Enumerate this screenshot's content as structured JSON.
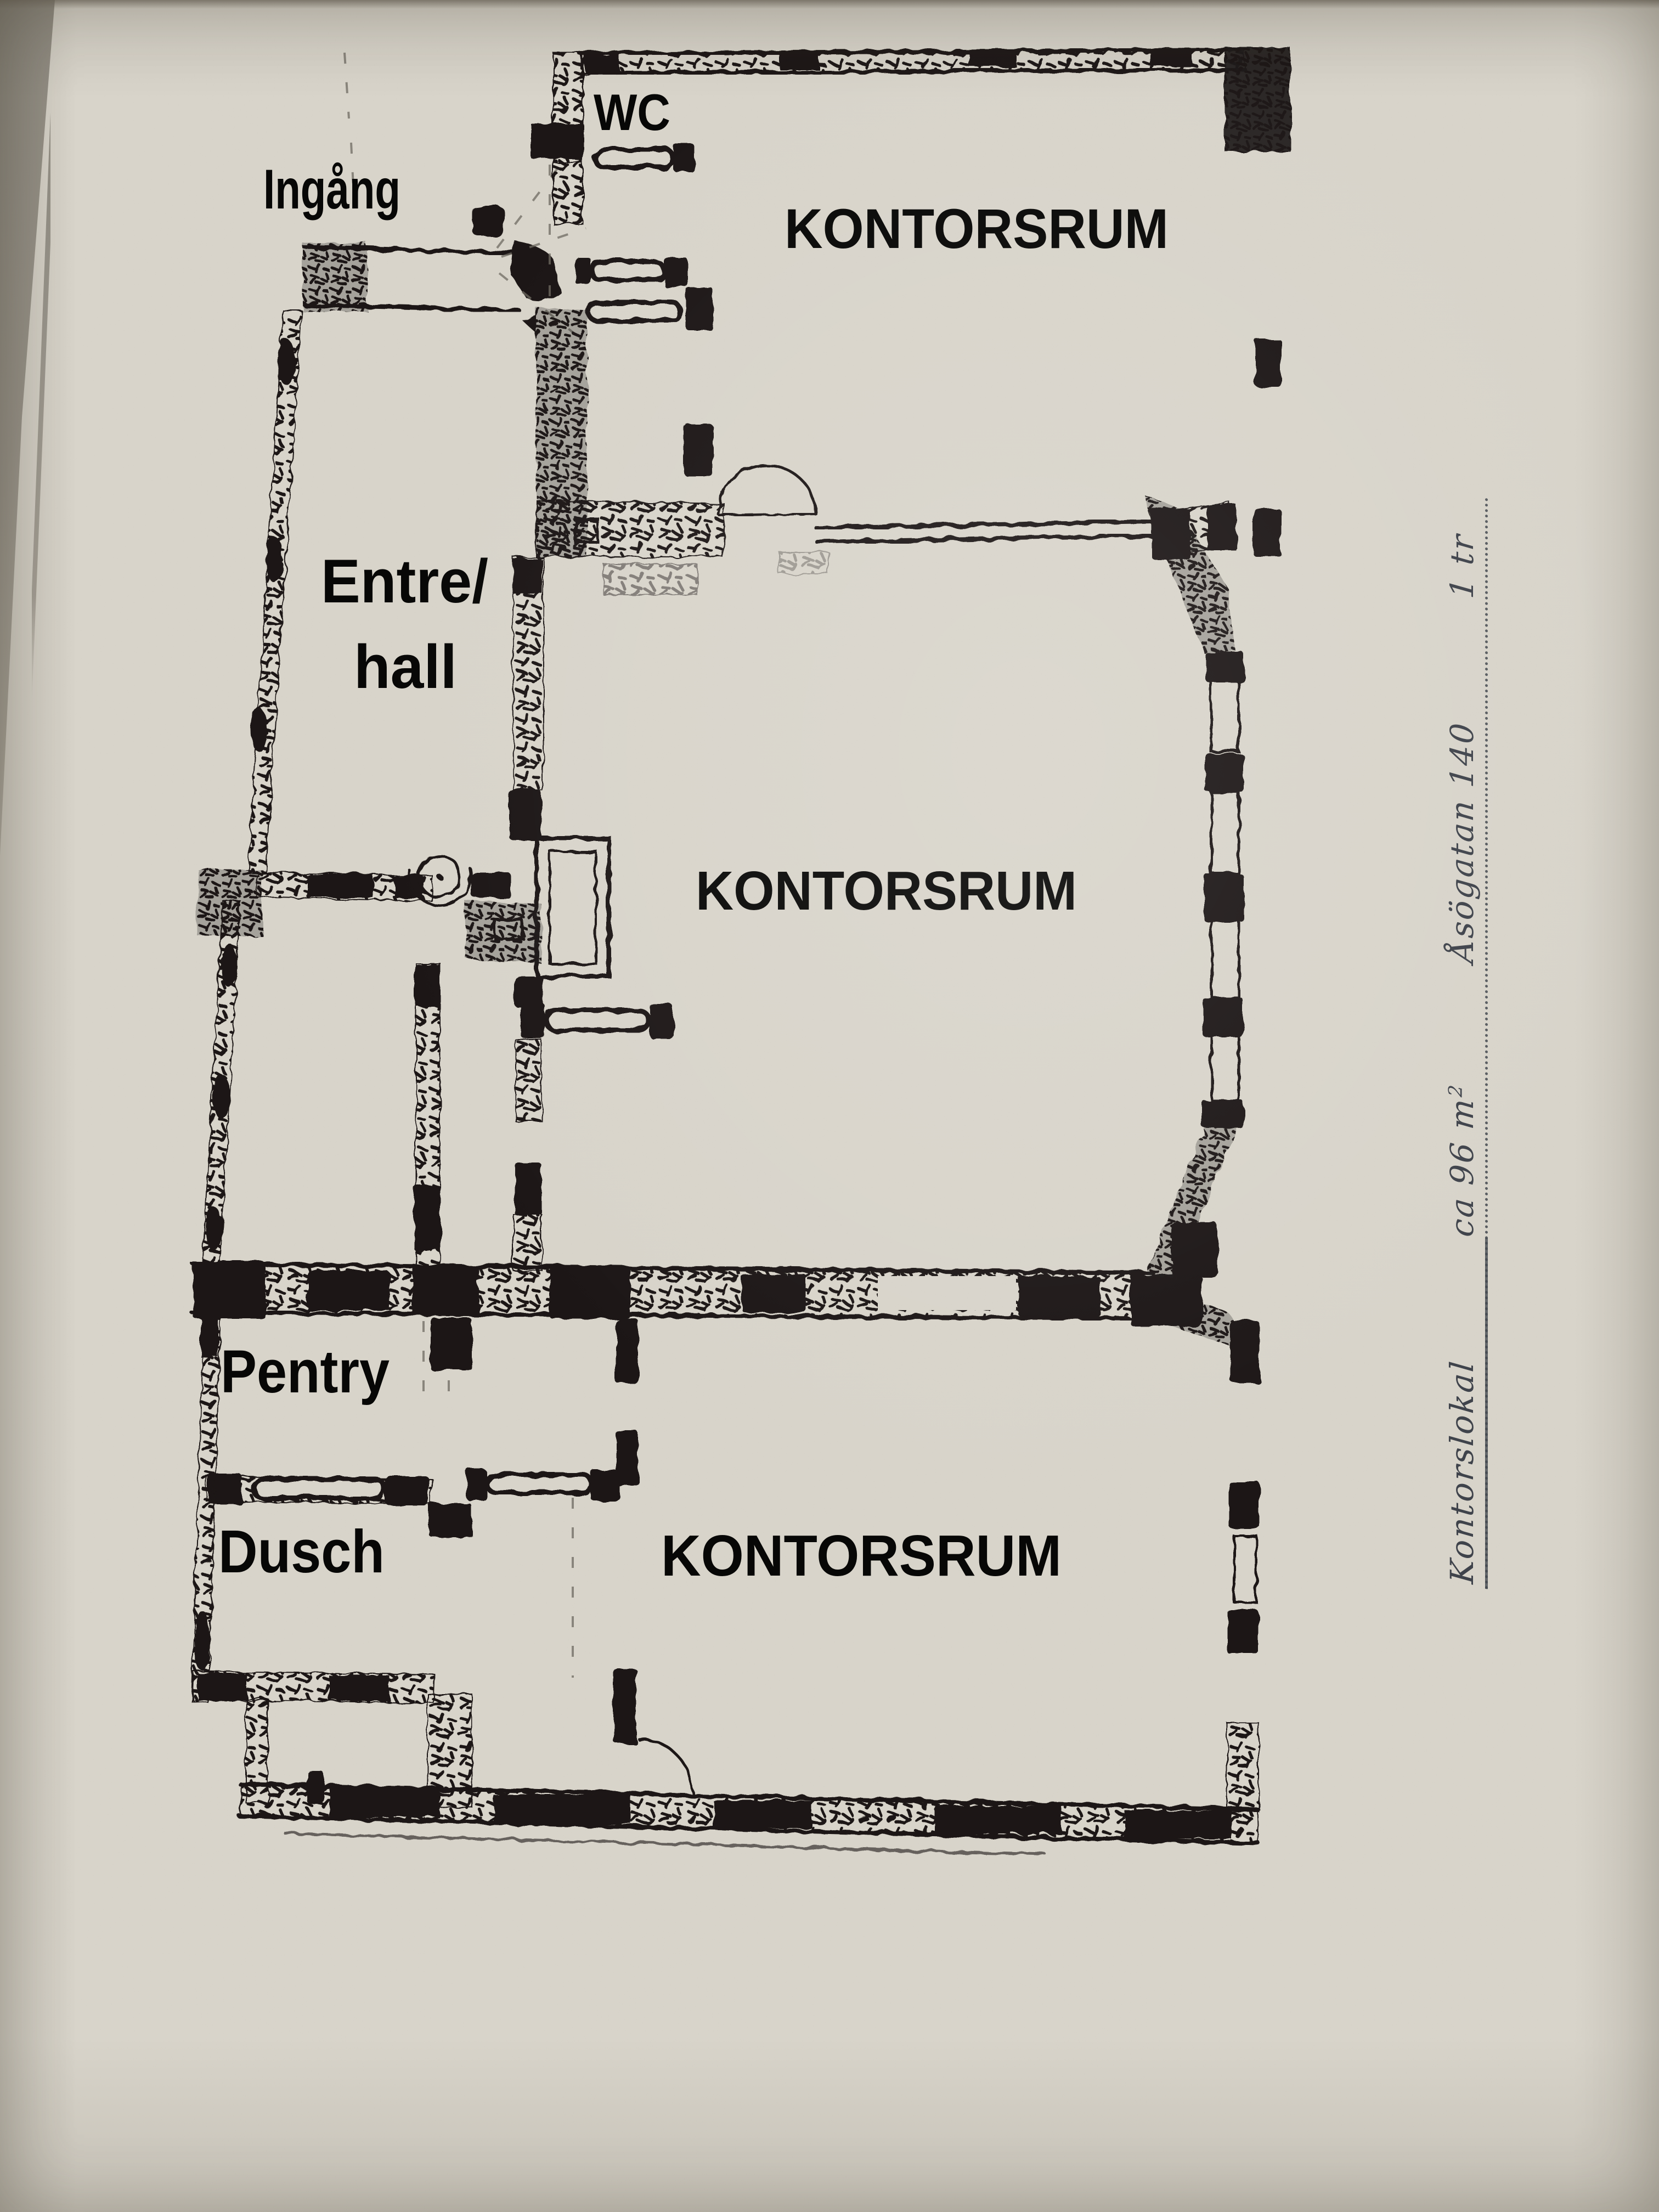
{
  "photo": {
    "paper_color": "#d8d4ca",
    "ink_color": "#1c1914",
    "note_ink_color": "#3f434b",
    "background_surface_color": "#8e8a80"
  },
  "plan": {
    "type": "floor-plan",
    "labels": [
      {
        "id": "ingang",
        "text": "Ingång"
      },
      {
        "id": "wc",
        "text": "WC"
      },
      {
        "id": "kontorsrum_top",
        "text": "KONTORSRUM"
      },
      {
        "id": "entre_line1",
        "text": "Entre/"
      },
      {
        "id": "entre_line2",
        "text": "hall"
      },
      {
        "id": "kontorsrum_mid",
        "text": "KONTORSRUM"
      },
      {
        "id": "pentry",
        "text": "Pentry"
      },
      {
        "id": "dusch",
        "text": "Dusch"
      },
      {
        "id": "kontorsrum_bottom",
        "text": "KONTORSRUM"
      }
    ]
  },
  "handwritten_note": {
    "part1": "Kontorslokal",
    "part2": "ca 96 m",
    "superscript": "2",
    "part3": "Åsögatan 140",
    "part4": "1 tr"
  }
}
